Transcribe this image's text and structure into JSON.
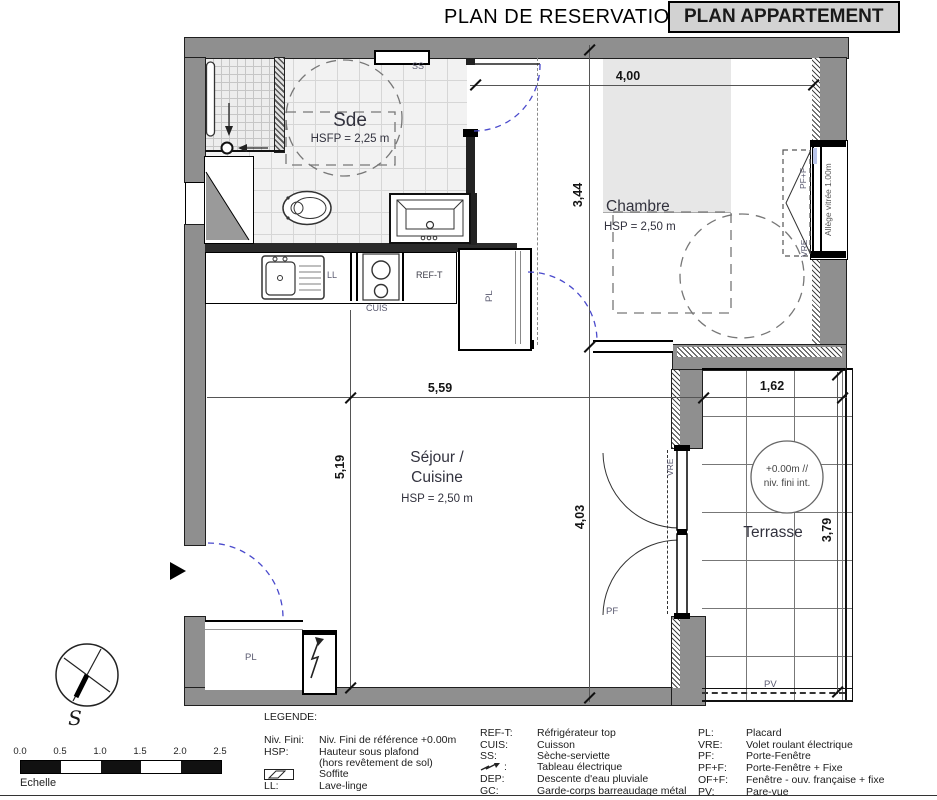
{
  "header": {
    "title": "PLAN DE RESERVATION",
    "badge": "PLAN APPARTEMENT"
  },
  "rooms": {
    "sde": {
      "name": "Sde",
      "height": "HSFP = 2,25 m"
    },
    "chambre": {
      "name": "Chambre",
      "height": "HSP = 2,50 m"
    },
    "sejour": {
      "line1": "Séjour /",
      "line2": "Cuisine",
      "height": "HSP = 2,50 m"
    },
    "terrasse": {
      "name": "Terrasse",
      "level1": "+0.00m //",
      "level2": "niv. fini int."
    }
  },
  "dimensions": {
    "chambre_w": "4,00",
    "chambre_d": "3,44",
    "sejour_w": "5,59",
    "sejour_d": "5,19",
    "bay_d": "4,03",
    "terrasse_w": "1,62",
    "terrasse_d": "3,79"
  },
  "tags": {
    "ss": "SS",
    "ll": "LL",
    "cuis": "CUIS",
    "ref_t": "REF-T",
    "pl_hall": "PL",
    "pl_entry": "PL",
    "pf_f": "PF+F",
    "vre_chambre": "VRE",
    "vre_terrasse": "VRE",
    "pf": "PF",
    "pv": "PV",
    "allege": "Allège vitrée 1.00m"
  },
  "compass": {
    "south": "S"
  },
  "scalebar": {
    "ticks": [
      "0.0",
      "0.5",
      "1.0",
      "1.5",
      "2.0",
      "2.5"
    ],
    "label": "Echelle"
  },
  "legend": {
    "title": "LEGENDE:",
    "col1": [
      {
        "abbr": "Niv. Fini:",
        "desc": "Niv. Fini de référence +0.00m"
      },
      {
        "abbr": "HSP:",
        "desc": "Hauteur sous plafond"
      },
      {
        "abbr": "",
        "desc": "(hors revêtement de sol)"
      },
      {
        "abbr": "",
        "desc": "Soffite"
      },
      {
        "abbr": "LL:",
        "desc": "Lave-linge"
      }
    ],
    "col2": [
      {
        "abbr": "REF-T:",
        "desc": "Réfrigérateur top"
      },
      {
        "abbr": "CUIS:",
        "desc": "Cuisson"
      },
      {
        "abbr": "SS:",
        "desc": "Sèche-serviette"
      },
      {
        "abbr": ":",
        "desc": "Tableau électrique"
      },
      {
        "abbr": "DEP:",
        "desc": "Descente d'eau pluviale"
      },
      {
        "abbr": "GC:",
        "desc": "Garde-corps barreaudage métal"
      }
    ],
    "col3": [
      {
        "abbr": "PL:",
        "desc": "Placard"
      },
      {
        "abbr": "VRE:",
        "desc": "Volet roulant électrique"
      },
      {
        "abbr": "PF:",
        "desc": "Porte-Fenêtre"
      },
      {
        "abbr": "PF+F:",
        "desc": "Porte-Fenêtre + Fixe"
      },
      {
        "abbr": "OF+F:",
        "desc": "Fenêtre - ouv. française + fixe"
      },
      {
        "abbr": "PV:",
        "desc": "Pare-vue"
      }
    ]
  },
  "colors": {
    "wall": "#8f8f8f",
    "badge_bg": "#d2d2d2",
    "door_arc": "#4a4acc",
    "soffite": "#e7e7e7",
    "tile_line": "#d6d6d6"
  }
}
